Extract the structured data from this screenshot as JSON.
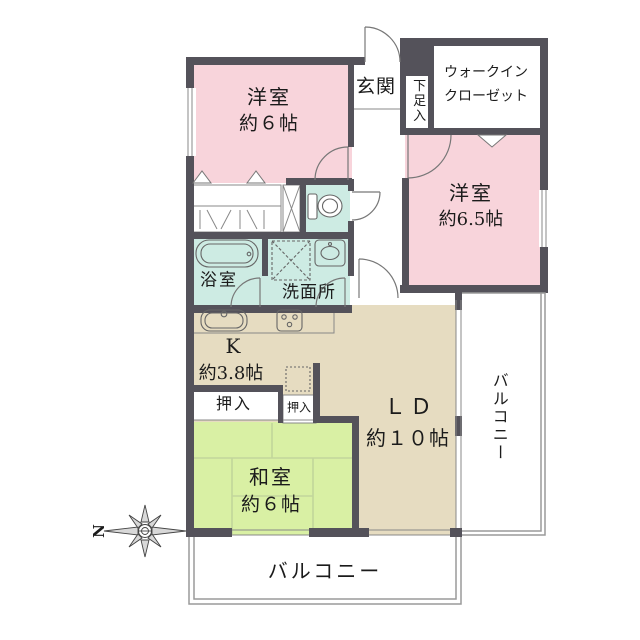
{
  "colors": {
    "wall": "#54525A",
    "room_pink": "#F8D4DB",
    "room_tan": "#E6DCC1",
    "room_green": "#D9F0A4",
    "room_teal": "#CDEBE3",
    "balcony_line": "#9A9A9A"
  },
  "rooms": {
    "western1": {
      "name": "洋室",
      "size": "約６帖"
    },
    "western2": {
      "name": "洋室",
      "size": "約6.5帖"
    },
    "japanese": {
      "name": "和室",
      "size": "約６帖"
    },
    "living_dining": {
      "name": "ＬＤ",
      "size": "約１０帖"
    },
    "kitchen": {
      "name": "K",
      "size": "約3.8帖"
    },
    "entrance": {
      "name": "玄関"
    },
    "shoe_storage": {
      "name": "下足入"
    },
    "walk_in_closet": {
      "line1": "ウォークイン",
      "line2": "クローゼット"
    },
    "bathroom": {
      "name": "浴室"
    },
    "washroom": {
      "name": "洗面所"
    },
    "closet_large": {
      "name": "押入"
    },
    "closet_small": {
      "name": "押入"
    },
    "balcony_right": {
      "name": "バルコニー"
    },
    "balcony_bottom": {
      "name": "バルコニー"
    }
  },
  "compass": {
    "north_label": "N"
  }
}
